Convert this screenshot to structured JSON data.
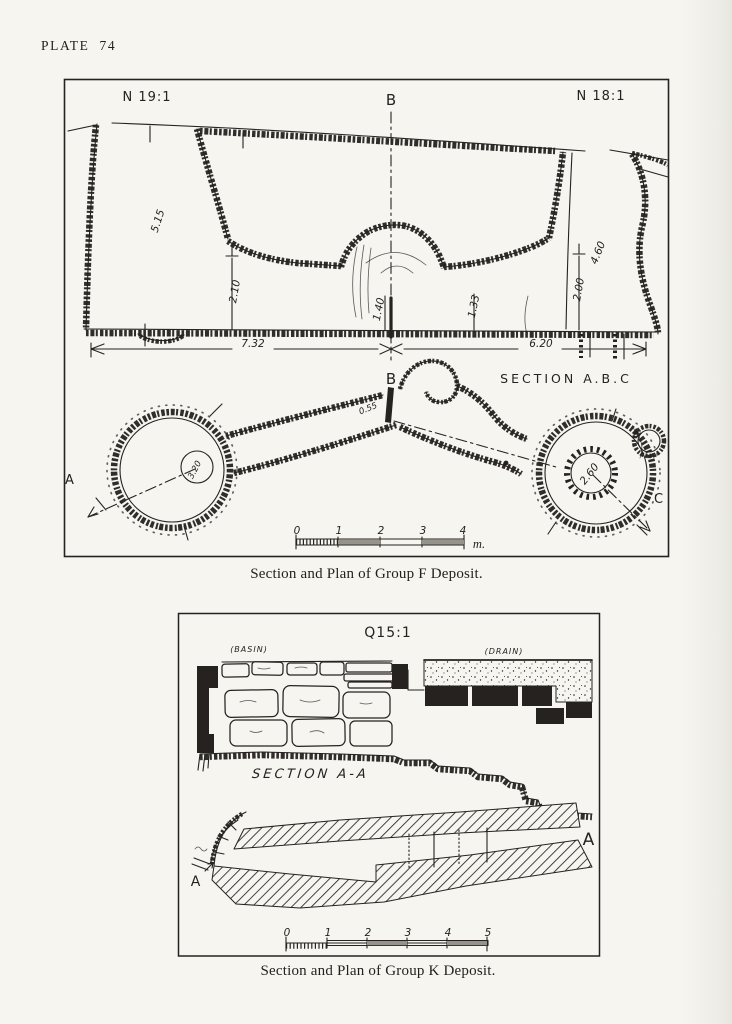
{
  "page": {
    "plate_label": "PLATE 74",
    "paper_color": "#f6f5f0",
    "ink_color": "#262220"
  },
  "figure_f": {
    "grid_labels": {
      "left": "N 19:1",
      "right": "N 18:1"
    },
    "section_point_top": "B",
    "section_point_bottom": "B",
    "section_title": "SECTION A.B.C",
    "plan_points": {
      "a": "A",
      "c": "C"
    },
    "measurements": {
      "left_shaft_depth": "5.15",
      "left_cavity_height": "2.10",
      "niche_left_height": "1.40",
      "niche_right_height": "1.33",
      "right_cavity_height": "2.00",
      "right_shaft_depth": "4.60",
      "left_span": "7.32",
      "right_span": "6.20",
      "left_chamber_diameter": "3.20",
      "right_chamber_diameter": "2.60",
      "passage_width": "0.55"
    },
    "scale": {
      "ticks": [
        "0",
        "1",
        "2",
        "3",
        "4"
      ],
      "unit": "m."
    },
    "caption": "Section and Plan of Group F Deposit."
  },
  "figure_k": {
    "grid_label": "Q15:1",
    "feature_labels": {
      "basin": "(BASIN)",
      "drain": "(DRAIN)"
    },
    "section_title": "SECTION A-A",
    "plan_points": {
      "a_left": "A",
      "a_right": "A"
    },
    "scale": {
      "ticks": [
        "0",
        "1",
        "2",
        "3",
        "4",
        "5"
      ]
    },
    "caption": "Section and Plan of Group K Deposit."
  }
}
